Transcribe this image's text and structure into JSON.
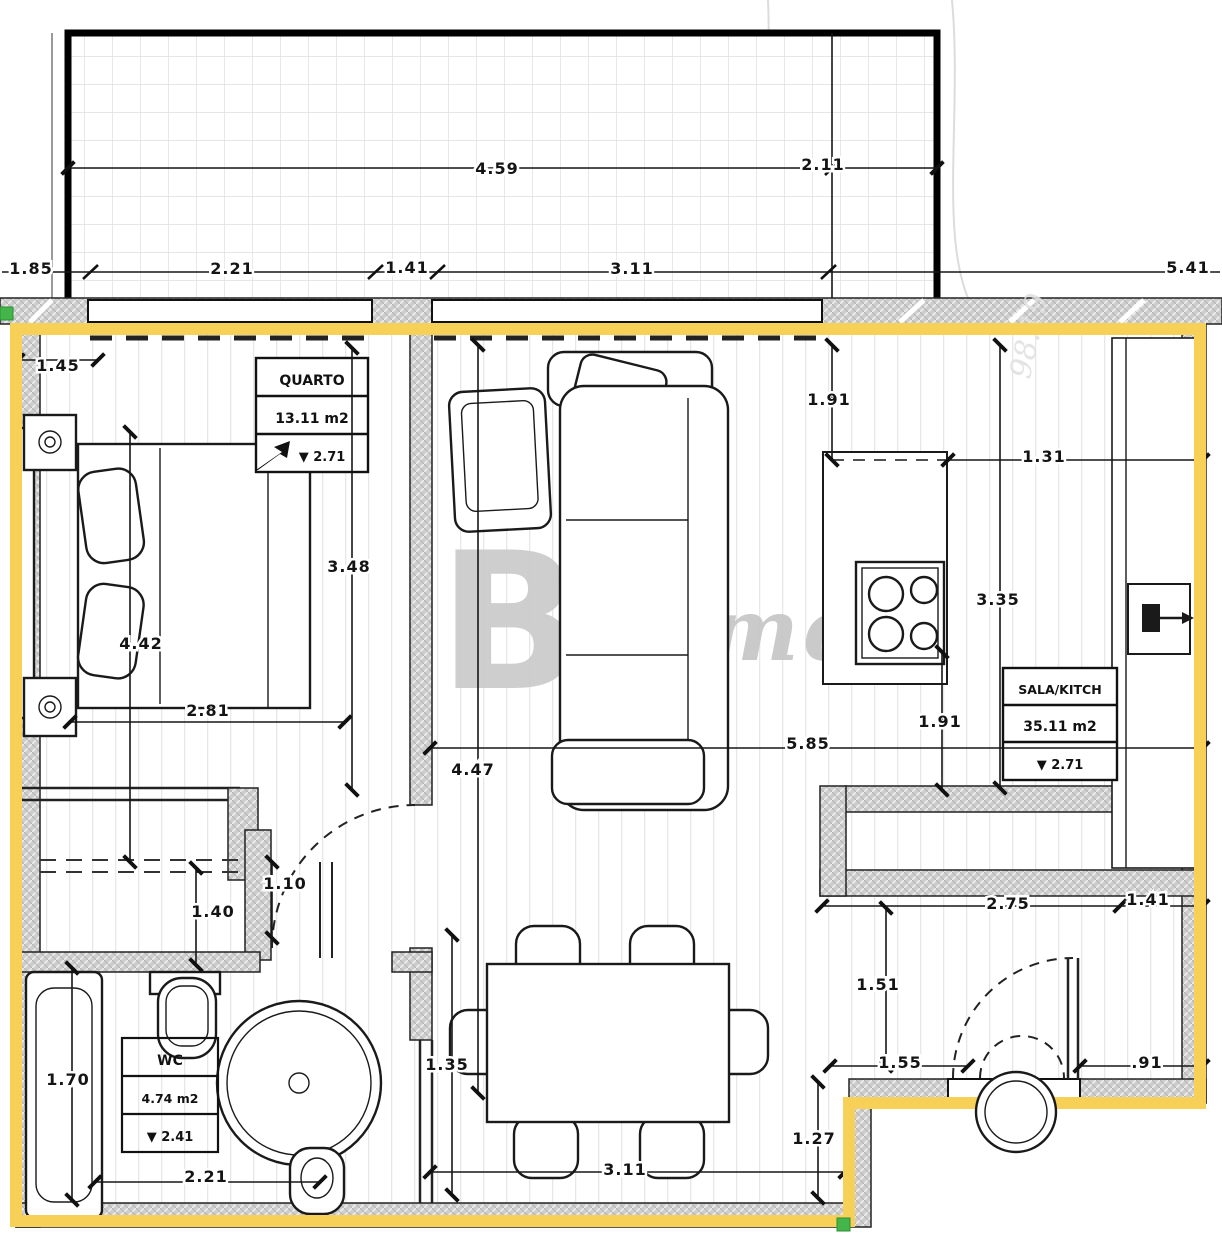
{
  "plan": {
    "title": "apartment-floor-plan",
    "accent_yellow": "#f7d057",
    "grip_green": "#44b54a",
    "watermark": {
      "letter": "B",
      "at": "@",
      "word": "home",
      "faint": "98.19"
    },
    "rooms": {
      "quarto": {
        "name": "QUARTO",
        "area": "13.11 m2",
        "level": "▼ 2.71"
      },
      "sala": {
        "name": "SALA/KITCH",
        "area": "35.11 m2",
        "level": "▼ 2.71"
      },
      "wc": {
        "name": "WC",
        "area": "4.74 m2",
        "level": "▼ 2.41"
      }
    },
    "dims": [
      "4.59",
      "2.11",
      "1.85",
      "2.21",
      "1.41",
      "3.11",
      "5.41",
      "1.45",
      "1.91",
      "1.31",
      "3.48",
      "4.42",
      "3.35",
      "2.81",
      "1.91",
      "5.85",
      "4.47",
      "1.10",
      "1.40",
      "2.75",
      "1.41",
      "1.51",
      "1.70",
      "1.55",
      ".91",
      "1.35",
      "1.27",
      "3.11",
      "2.21"
    ]
  }
}
